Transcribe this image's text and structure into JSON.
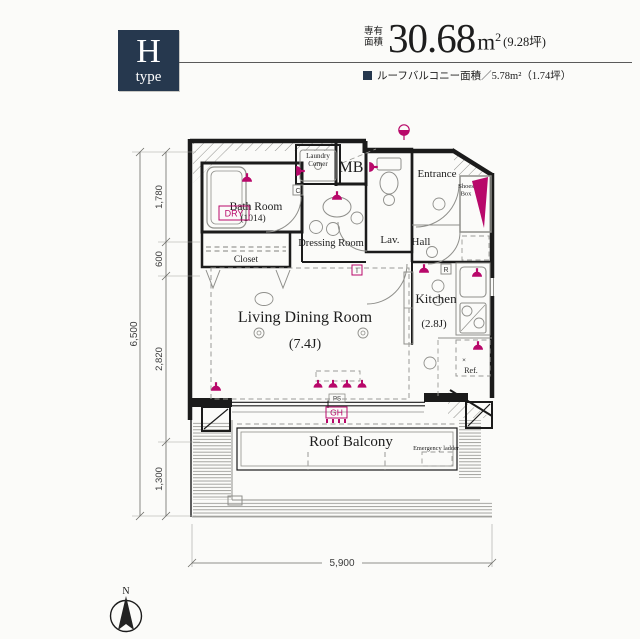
{
  "title": "H type floor plan",
  "colors": {
    "navy": "#26384e",
    "accent": "#b8086a",
    "wall": "#1b1b1b"
  },
  "header": {
    "type_letter": "H",
    "type_word": "type",
    "area_label_1": "専有",
    "area_label_2": "面積",
    "area_value": "30.68",
    "area_unit": "m",
    "area_unit_exp": "2",
    "area_tsubo": "(9.28坪)",
    "balcony_note": "ルーフバルコニー面積／5.78m²（1.74坪）"
  },
  "plan": {
    "labels": {
      "bath": "Bath Room",
      "bath_size": "(1014)",
      "dry": "DRY",
      "laundry_1": "Laundry",
      "laundry_2": "Corner",
      "mb": "MB",
      "lav": "Lav.",
      "entrance": "Entrance",
      "shoes_1": "Shoes",
      "shoes_2": "Box",
      "dressing": "Dressing Room",
      "closet": "Closet",
      "hall": "Hall",
      "kitchen": "Kitchen",
      "kitchen_size": "(2.8J)",
      "living": "Living Dining Room",
      "living_size": "(7.4J)",
      "ref": "Ref.",
      "x_mark": "×",
      "balcony": "Roof Balcony",
      "ladder": "Emergency ladder",
      "gh": "GH",
      "ps": "PS",
      "box_c": "C",
      "box_r": "R",
      "box_i": "I"
    }
  },
  "dimensions": {
    "left_total": "6,500",
    "left_1": "1,780",
    "left_2": "600",
    "left_3": "2,820",
    "left_4": "1,300",
    "bottom": "5,900"
  },
  "compass": {
    "north": "N"
  }
}
